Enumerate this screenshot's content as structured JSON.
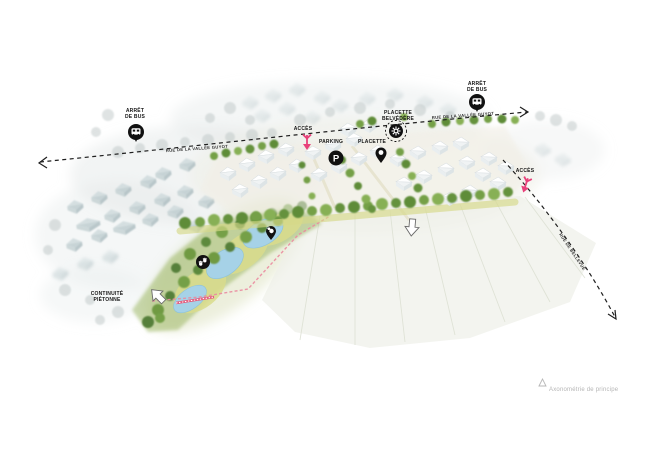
{
  "roads": {
    "main_name_west": "RUE DE LA VALLÉE GUYOT",
    "main_name_east": "RUE DE LA VALLÉE GUYOT",
    "side_name": "RUE DE BELLEVUE"
  },
  "labels": {
    "bus_stop_west_line1": "ARRÊT",
    "bus_stop_west_line2": "DE BUS",
    "bus_stop_east_line1": "ARRÊT",
    "bus_stop_east_line2": "DE BUS",
    "access_main": "ACCÈS",
    "access_east": "ACCÈS",
    "parking": "PARKING",
    "parking_symbol": "P",
    "placette": "PLACETTE",
    "belvedere_line1": "PLACETTE",
    "belvedere_line2": "BELVÉDÈRE",
    "pedestrian_line1": "CONTINUITÉ",
    "pedestrian_line2": "PIÉTONNE"
  },
  "caption": "Axonométrie de principe",
  "icons": {
    "bus": "bus-icon",
    "parking": "parking-icon",
    "placette": "map-pin-icon",
    "belvedere": "belvedere-star-icon",
    "pond_bird": "duck-pin-icon",
    "wildlife": "animal-tracks-icon",
    "access": "access-arrow-icon",
    "pedestrian": "pedestrian-arrow-icon",
    "north": "north-triangle-icon"
  },
  "colors": {
    "accent_pink": "#e8417a",
    "path_pink": "#ea8ba0",
    "road_black": "#1f1f1f",
    "tree_green": "#6f9a43",
    "dark_green": "#56803a",
    "meadow_yellow_green": "#d8db8c",
    "pond_blue": "#a6d2e7",
    "existing_roof_blue_gray": "#b7c8cb",
    "new_house_white": "#ffffff",
    "field_pale": "#eef0e8",
    "caption_gray": "#b5b5b5"
  }
}
